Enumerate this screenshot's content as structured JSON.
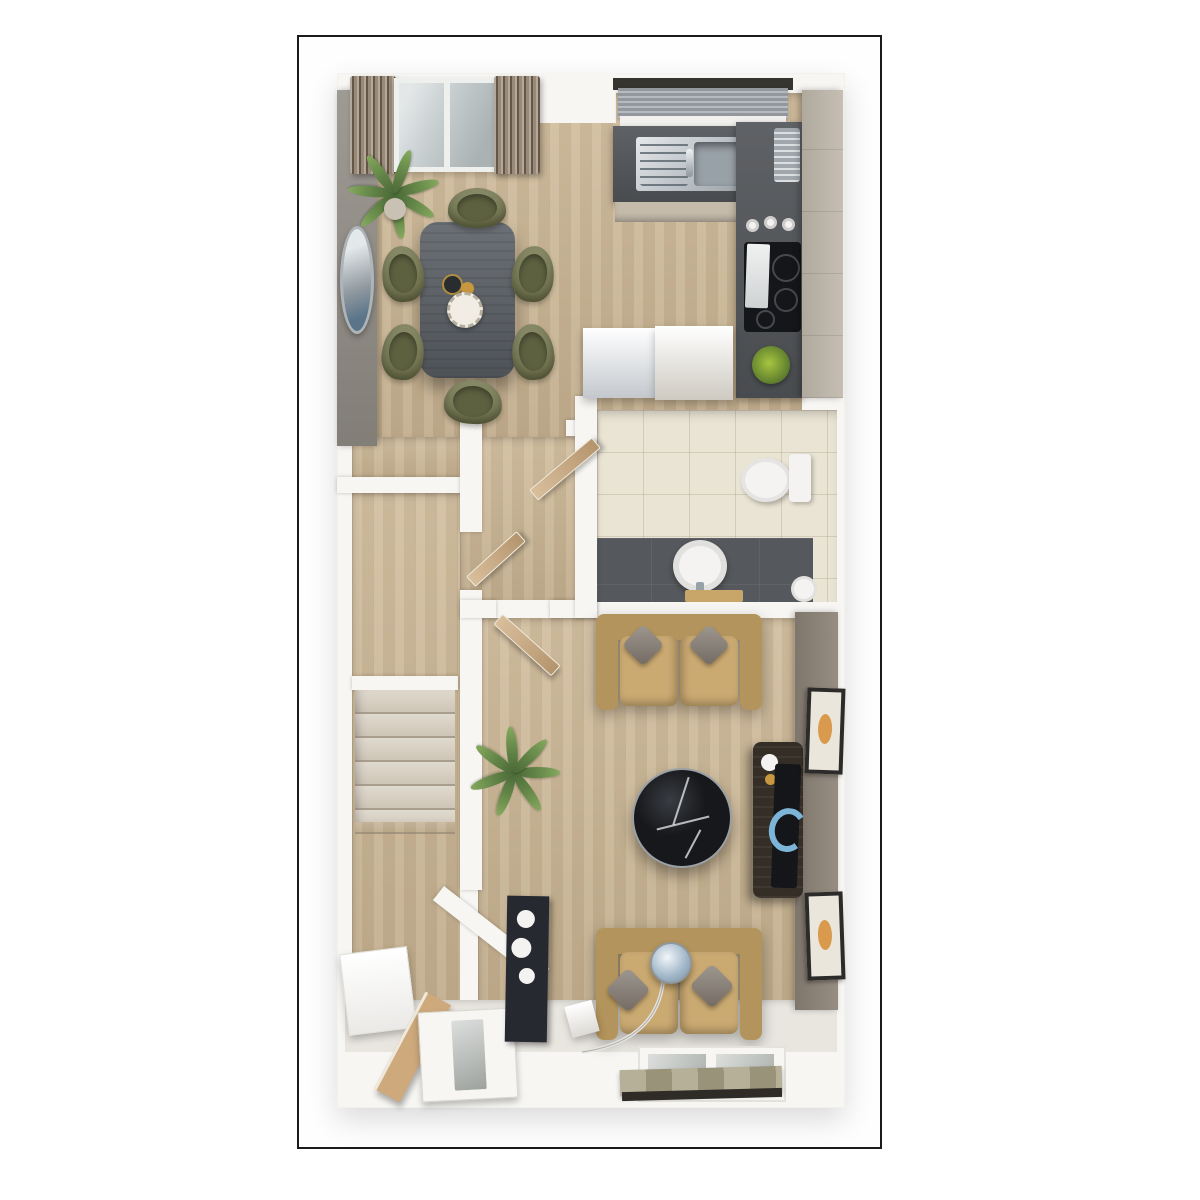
{
  "scene": {
    "type": "3d-floorplan-render",
    "description": "Top-down 3D architectural floor plan render of an apartment ground floor, no text labels",
    "rooms": [
      {
        "name": "dining-area",
        "furnishings": [
          "dining-table",
          "dining-chairs-x6",
          "potted-palm",
          "wall-mirror",
          "curtains",
          "french-doors",
          "decor-vase",
          "decor-plate"
        ]
      },
      {
        "name": "kitchen",
        "furnishings": [
          "window-blind",
          "sink-unit",
          "worktop",
          "hob",
          "canisters",
          "tall-cabinets",
          "fridge-freezer",
          "appliance-unit",
          "herb-plant"
        ]
      },
      {
        "name": "wc",
        "furnishings": [
          "toilet",
          "round-basin",
          "wooden-mat",
          "waste-bin"
        ]
      },
      {
        "name": "hallway",
        "furnishings": [
          "staircase",
          "open-doors-x3"
        ]
      },
      {
        "name": "living-room",
        "furnishings": [
          "sofa-x2",
          "scatter-cushions",
          "round-marble-coffee-table",
          "media-unit",
          "tv",
          "wall-art-x2",
          "arc-floor-lamp",
          "side-table",
          "potted-palm",
          "rear-window",
          "roman-blind"
        ]
      },
      {
        "name": "entry",
        "furnishings": [
          "front-door",
          "console-shelf",
          "leaning-board",
          "dark-cabinet"
        ]
      }
    ]
  },
  "colors": {
    "page_bg": "#ffffff",
    "frame_border": "#1b1b1b",
    "wall_white": "#f7f6f3",
    "wall_gray": "#918c85",
    "wall_taupe": "#8d8378",
    "floor_wood": "#cdb794",
    "floor_pale": "#e9e6e0",
    "tile_cream": "#eae4d4",
    "tile_dark": "#55585c",
    "counter_dark": "#53565a",
    "cabinet_beige": "#bfb7aa",
    "cabinet_front": "#c5bbaa",
    "fridge_gray": "#ced3d8",
    "unit_beige": "#d9d5cc",
    "blind_gray": "#9ba1a7",
    "pelmet_dark": "#36342f",
    "curtain_brown": "#8a7a67",
    "glass_blue": "#c2cacc",
    "sill_white": "#f2f1ee",
    "table_charcoal": "#5b6066",
    "chair_olive": "#767950",
    "chair_seat": "#5d6140",
    "sofa_tan": "#b3945c",
    "sofa_seat": "#cbaa72",
    "cushion_gray": "#877e74",
    "marble_black": "#17181b",
    "media_dark": "#352e27",
    "tv_black": "#14161a",
    "screen_blue": "#7cb5d8",
    "art_orange": "#d99a4e",
    "frame_dark": "#2c2b29",
    "art_mat": "#eae6dc",
    "door_wood": "#cda97c",
    "stair_carpet": "#d6cdbe",
    "white_fixture": "#f4f3f1",
    "lamp_chrome": "#c6ccd2",
    "blind_olive": "#a69f83",
    "rod_dark": "#2f2c28",
    "cabinet_dark": "#262a30",
    "steel": "#b7bec4",
    "basin_steel": "#99a1a8",
    "cooktop_black": "#141619",
    "gold": "#c9973f",
    "vase_dark": "#2a2d30",
    "plate_white": "#f1ede4",
    "plant_green": "#6c9150",
    "pot_beige": "#c9c2b4",
    "wood_mat": "#c8a568",
    "glass_pane": "#b9beba"
  }
}
